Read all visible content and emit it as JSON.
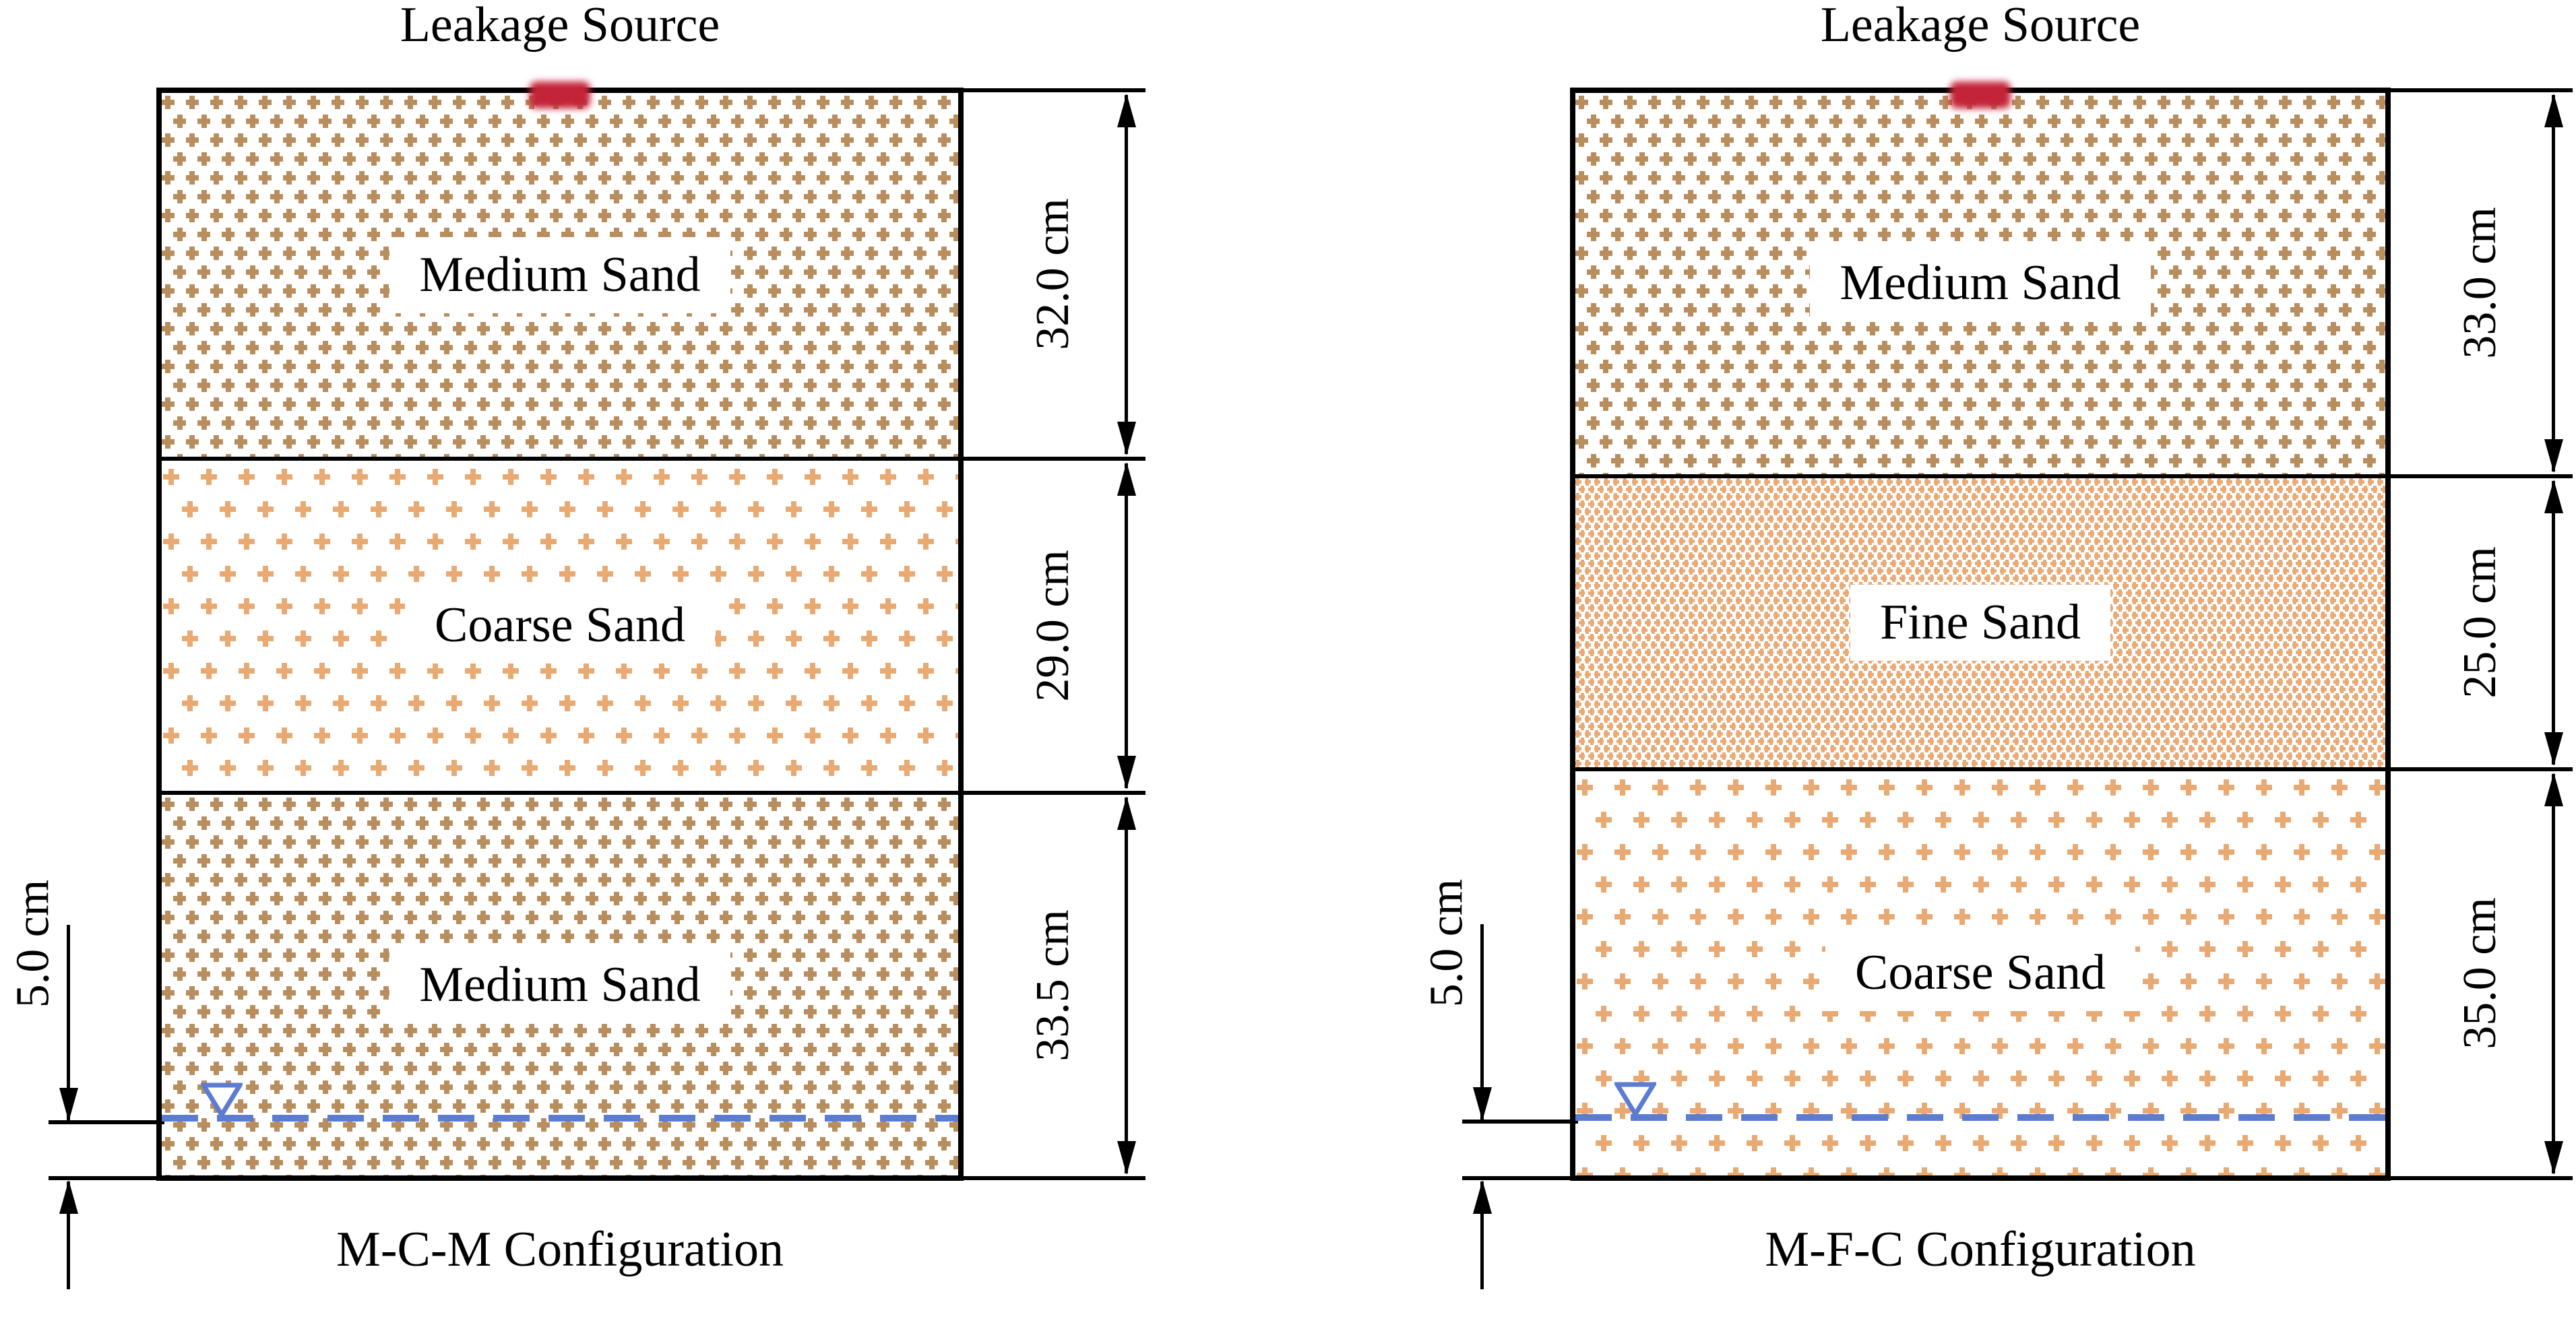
{
  "figure": {
    "description_left": "Layered sand column with leakage source at top",
    "water_line_style": "dashed"
  },
  "colors": {
    "line_black": "#000000",
    "medium_sand": "#b98e5f",
    "coarse_sand": "#e8a973",
    "fine_sand": "#e9aa76",
    "water_blue": "#5b7cd0",
    "leak_red": "#c32438",
    "label_bg": "#ffffff"
  },
  "icons": {
    "water_table_symbol": "open inverted triangle (nabla) on water line",
    "leakage_marker": "red blurred rectangle at top center",
    "dimension_arrow": "double-headed vertical arrow"
  },
  "diagrams": [
    {
      "title": "Leakage Source",
      "config_label": "M-C-M Configuration",
      "layers": [
        {
          "name": "Medium Sand",
          "thickness_label": "32.0 cm",
          "thickness_cm": 32.0,
          "pattern": "medium"
        },
        {
          "name": "Coarse Sand",
          "thickness_label": "29.0 cm",
          "thickness_cm": 29.0,
          "pattern": "coarse"
        },
        {
          "name": "Medium Sand",
          "thickness_label": "33.5 cm",
          "thickness_cm": 33.5,
          "pattern": "medium"
        }
      ],
      "water_table": {
        "depth_label": "5.0 cm",
        "depth_cm": 5.0
      }
    },
    {
      "title": "Leakage Source",
      "config_label": "M-F-C Configuration",
      "layers": [
        {
          "name": "Medium Sand",
          "thickness_label": "33.0 cm",
          "thickness_cm": 33.0,
          "pattern": "medium"
        },
        {
          "name": "Fine Sand",
          "thickness_label": "25.0 cm",
          "thickness_cm": 25.0,
          "pattern": "fine"
        },
        {
          "name": "Coarse Sand",
          "thickness_label": "35.0 cm",
          "thickness_cm": 35.0,
          "pattern": "coarse"
        }
      ],
      "water_table": {
        "depth_label": "5.0 cm",
        "depth_cm": 5.0
      }
    }
  ]
}
